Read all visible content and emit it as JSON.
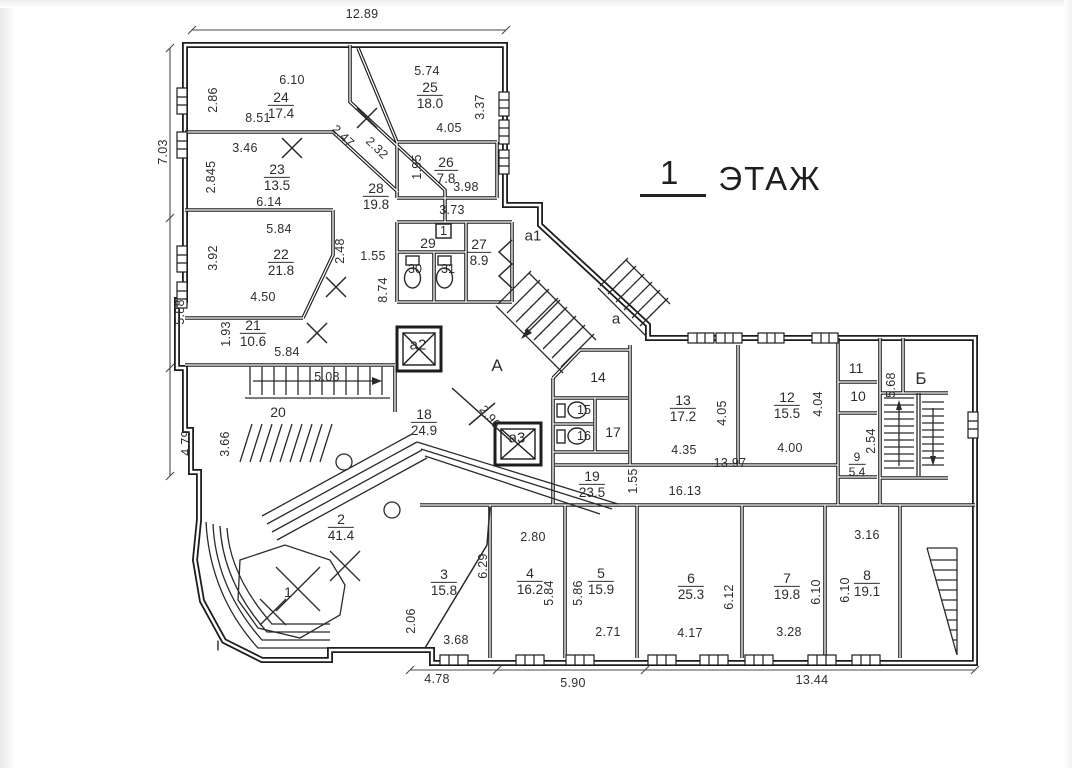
{
  "title": {
    "n": "1",
    "w": "ЭТАЖ"
  },
  "rooms": {
    "r24": {
      "n": "24",
      "a": "17.4"
    },
    "r25": {
      "n": "25",
      "a": "18.0"
    },
    "r23": {
      "n": "23",
      "a": "13.5"
    },
    "r26": {
      "n": "26",
      "a": "7.8"
    },
    "r28": {
      "n": "28",
      "a": "19.8"
    },
    "r27": {
      "n": "27",
      "a": "8.9"
    },
    "r22": {
      "n": "22",
      "a": "21.8"
    },
    "r21": {
      "n": "21",
      "a": "10.6"
    },
    "r18": {
      "n": "18",
      "a": "24.9"
    },
    "r13": {
      "n": "13",
      "a": "17.2"
    },
    "r12": {
      "n": "12",
      "a": "15.5"
    },
    "r19": {
      "n": "19",
      "a": "23.5"
    },
    "r9": {
      "n": "9",
      "a": "5.4"
    },
    "r2": {
      "n": "2",
      "a": "41.4"
    },
    "r3": {
      "n": "3",
      "a": "15.8"
    },
    "r4": {
      "n": "4",
      "a": "16.2"
    },
    "r5": {
      "n": "5",
      "a": "15.9"
    },
    "r6": {
      "n": "6",
      "a": "25.3"
    },
    "r7": {
      "n": "7",
      "a": "19.8"
    },
    "r8": {
      "n": "8",
      "a": "19.1"
    }
  },
  "plain": {
    "p20": "20",
    "p14": "14",
    "p15": "15",
    "p16": "16",
    "p17": "17",
    "p29": "29",
    "p30": "30",
    "p31": "31",
    "p10": "10",
    "p11": "11",
    "p1": "1",
    "tag1": "1"
  },
  "zones": {
    "a_up": "А",
    "a_low": "а",
    "a1": "а1",
    "a2": "а2",
    "a3": "а3",
    "b": "Б",
    "porch": "I"
  },
  "dims": [
    "12.89",
    "6.10",
    "2.86",
    "8.51",
    "5.74",
    "3.37",
    "4.05",
    "3.46",
    "2.845",
    "6.14",
    "2.47",
    "2.32",
    "1.95",
    "3.98",
    "3.73",
    "5.84",
    "3.92",
    "2.48",
    "1.55",
    "8.74",
    "4.50",
    "7.03",
    "5.88",
    "1.93",
    "5.84",
    "5.08",
    "4.79",
    "3.66",
    "2.96",
    "4.05",
    "4.35",
    "4.04",
    "4.00",
    "13.97",
    "1.55",
    "16.13",
    "5.68",
    "2.54",
    "2.80",
    "6.29",
    "5.84",
    "5.86",
    "2.71",
    "6.12",
    "4.17",
    "6.10",
    "3.28",
    "6.10",
    "3.16",
    "2.06",
    "3.68",
    "4.78",
    "5.90",
    "13.44"
  ],
  "line_color": "#1d1d1d"
}
